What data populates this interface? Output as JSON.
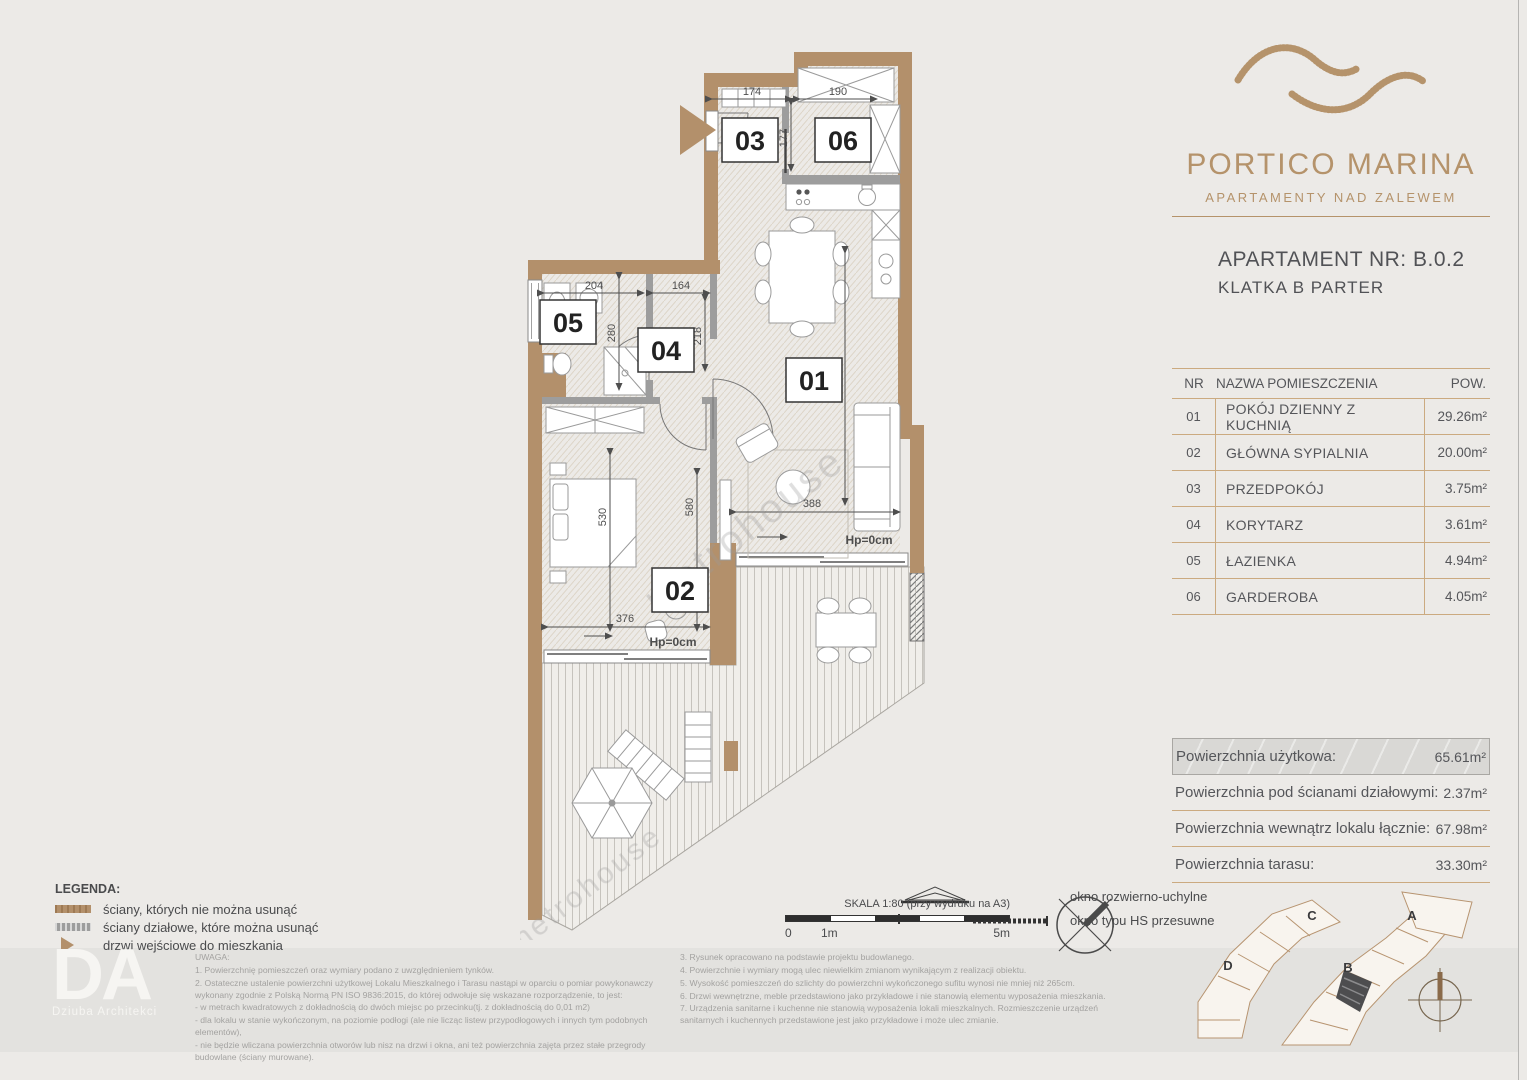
{
  "brand": {
    "name": "PORTICO MARINA",
    "tagline": "APARTAMENTY NAD ZALEWEM"
  },
  "apartment": {
    "title": "APARTAMENT NR: B.0.2",
    "subtitle": "KLATKA B PARTER"
  },
  "rooms_table": {
    "headers": {
      "nr": "NR",
      "name": "NAZWA POMIESZCZENIA",
      "area": "POW."
    },
    "rows": [
      {
        "nr": "01",
        "name": "POKÓJ DZIENNY Z KUCHNIĄ",
        "area": "29.26m²"
      },
      {
        "nr": "02",
        "name": "GŁÓWNA SYPIALNIA",
        "area": "20.00m²"
      },
      {
        "nr": "03",
        "name": "PRZEDPOKÓJ",
        "area": "3.75m²"
      },
      {
        "nr": "04",
        "name": "KORYTARZ",
        "area": "3.61m²"
      },
      {
        "nr": "05",
        "name": "ŁAZIENKA",
        "area": "4.94m²"
      },
      {
        "nr": "06",
        "name": "GARDEROBA",
        "area": "4.05m²"
      }
    ]
  },
  "summary": {
    "rows": [
      {
        "label": "Powierzchnia użytkowa:",
        "value": "65.61m²"
      },
      {
        "label": "Powierzchnia pod ścianami działowymi:",
        "value": "2.37m²"
      },
      {
        "label": "Powierzchnia wewnątrz lokalu łącznie:",
        "value": "67.98m²"
      },
      {
        "label": "Powierzchnia tarasu:",
        "value": "33.30m²"
      }
    ]
  },
  "plan": {
    "labels": {
      "r01": "01",
      "r02": "02",
      "r03": "03",
      "r04": "04",
      "r05": "05",
      "r06": "06"
    },
    "dims": {
      "d174": "174",
      "d190": "190",
      "d177": "177",
      "d204": "204",
      "d164": "164",
      "d280": "280",
      "d218": "218",
      "d806": "806",
      "d530": "530",
      "d580": "580",
      "d376": "376",
      "d388": "388"
    },
    "hp": "Hp=0cm",
    "watermark": "metrohouse"
  },
  "legend": {
    "title": "LEGENDA:",
    "items": [
      "ściany, których nie można usunąć",
      "ściany działowe, które można usunąć",
      "drzwi wejściowe do mieszkania"
    ],
    "windows": [
      "okno rozwierno-uchylne",
      "okno typu HS przesuwne"
    ]
  },
  "scalebar": {
    "label": "SKALA 1:80 (przy wydruku na A3)",
    "t0": "0",
    "t1": "1m",
    "t5": "5m"
  },
  "notes": {
    "title": "UWAGA:",
    "col1": [
      "1. Powierzchnię pomieszczeń oraz wymiary podano z uwzględnieniem tynków.",
      "2. Ostateczne ustalenie powierzchni użytkowej Lokalu Mieszkalnego i Tarasu nastąpi w oparciu o pomiar powykonawczy wykonany zgodnie z Polską Normą PN ISO 9836:2015, do której odwołuje się wskazane rozporządzenie, to jest:",
      "- w metrach kwadratowych z dokładnością do dwóch miejsc po przecinku(tj. z dokładnością do 0,01 m2)",
      "- dla lokalu w stanie wykończonym, na poziomie podłogi (ale nie licząc listew przypodłogowych i innych tym podobnych elementów),",
      "- nie będzie wliczana powierzchnia otworów lub nisz na drzwi i okna, ani też powierzchnia zajęta przez stałe przegrody budowlane (ściany murowane)."
    ],
    "col2": [
      "3. Rysunek opracowano na podstawie projektu budowlanego.",
      "4. Powierzchnie i wymiary mogą ulec niewielkim zmianom wynikającym z realizacji obiektu.",
      "5. Wysokość pomieszczeń do szlichty do powierzchni wykończonego sufitu wynosi nie mniej niż 265cm.",
      "6. Drzwi wewnętrzne, meble przedstawiono jako przykładowe i nie stanowią elementu wyposażenia mieszkania.",
      "7. Urządzenia sanitarne i kuchenne nie stanowią wyposażenia lokali mieszkalnych. Rozmieszczenie urządzeń sanitarnych i kuchennych przedstawione jest jako przykładowe i może ulec zmianie."
    ]
  },
  "architect": {
    "initials": "DA",
    "name": "Dziuba Architekci"
  },
  "siteplan": {
    "labels": {
      "a": "A",
      "b": "B",
      "c": "C",
      "d": "D"
    }
  },
  "colors": {
    "accent": "#b5936b",
    "wall": "#b3906b",
    "partition": "#9d9d9d",
    "text_dark": "#55565a",
    "note_gray": "#a3a2a0",
    "highlight_bg": "#d9d8d5"
  }
}
